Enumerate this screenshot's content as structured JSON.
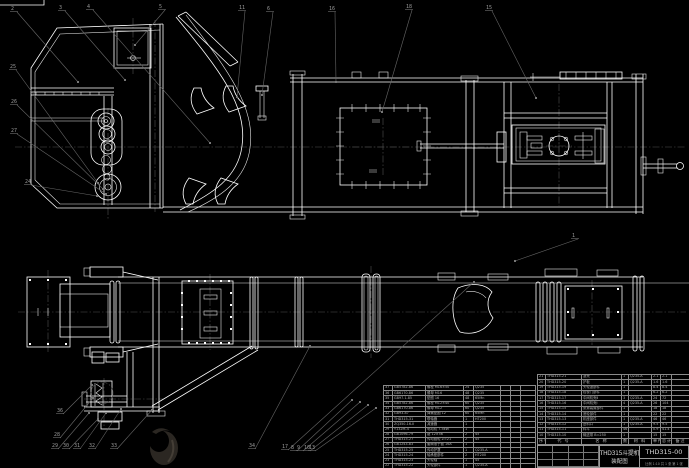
{
  "colors": {
    "background": "#000000",
    "line": "#ffffff",
    "leader": "#707070",
    "table_text": "#b0b0b0"
  },
  "title_block": {
    "product": "THD315斗提机",
    "doc_type": "装配图",
    "drawing_no": "THD315-00",
    "footer": "比例 1:10  共 1 张  第 1 张"
  },
  "bom_right": {
    "header": [
      "序号",
      "代  号",
      "名  称",
      "数量",
      "材  料",
      "单件",
      "总计",
      "备注"
    ],
    "rows": [
      [
        "21",
        "THD315-21",
        "罩壳",
        "1",
        "Q235-A",
        "2.1",
        "2.1",
        ""
      ],
      [
        "20",
        "THD315-20",
        "护板",
        "1",
        "Q235-A",
        "1.6",
        "1.6",
        ""
      ],
      [
        "19",
        "THD315-19",
        "头轮罩部件",
        "1",
        "",
        "8.4",
        "8.4",
        ""
      ],
      [
        "18",
        "THD315-18",
        "检视门部件",
        "1",
        "",
        "6.2",
        "6.2",
        ""
      ],
      [
        "17",
        "THD315-17",
        "中间机壳Ⅱ",
        "3",
        "Q235-A",
        "24",
        "72",
        ""
      ],
      [
        "16",
        "THD315-16",
        "中间机壳Ⅰ",
        "4",
        "Q235-A",
        "26",
        "104",
        ""
      ],
      [
        "15",
        "THD315-15",
        "张紧装置部件",
        "1",
        "",
        "18",
        "18",
        ""
      ],
      [
        "14",
        "THD315-14",
        "底轮部件",
        "1",
        "",
        "22",
        "22",
        ""
      ],
      [
        "13",
        "THD315-13",
        "机座部件",
        "1",
        "Q235-A",
        "46",
        "46",
        ""
      ],
      [
        "12",
        "THD315-12",
        "进料口",
        "1",
        "Q235-A",
        "9.5",
        "9.5",
        ""
      ],
      [
        "11",
        "THD315-11",
        "料斗",
        "46",
        "",
        "0.9",
        "41.4",
        ""
      ],
      [
        "10",
        "THD315-10",
        "输送带 B=250",
        "1",
        "",
        "15",
        "15",
        ""
      ]
    ]
  },
  "bom_left": {
    "rows": [
      [
        "37",
        "GB5782-86",
        "螺栓 M16×50",
        "24",
        "Q235",
        "",
        "",
        ""
      ],
      [
        "36",
        "GB6170-86",
        "螺母 M16",
        "48",
        "Q235",
        "",
        "",
        ""
      ],
      [
        "35",
        "GB97.1-85",
        "垫圈 16",
        "48",
        "65Mn",
        "",
        "",
        ""
      ],
      [
        "34",
        "GB5782-86",
        "螺栓 M12×40",
        "60",
        "Q235",
        "",
        "",
        ""
      ],
      [
        "33",
        "GB6170-86",
        "螺母 M12",
        "60",
        "Q235",
        "",
        "",
        ""
      ],
      [
        "32",
        "GB93-87",
        "弹簧垫圈 12",
        "60",
        "65Mn",
        "",
        "",
        ""
      ],
      [
        "31",
        "THD315-31",
        "联轴器",
        "1",
        "HT200",
        "",
        "",
        ""
      ],
      [
        "30",
        "ZQ350-16-Ⅱ",
        "减速器",
        "1",
        "",
        "",
        "",
        ""
      ],
      [
        "29",
        "Y132M-4",
        "电动机 7.5kW",
        "1",
        "",
        "",
        "",
        ""
      ],
      [
        "28",
        "GB1096-79",
        "键 12×56",
        "2",
        "45",
        "",
        "",
        ""
      ],
      [
        "27",
        "THD315-27",
        "传动链轮 Z=21",
        "2",
        "45",
        "",
        "",
        ""
      ],
      [
        "26",
        "GB1243-83",
        "套筒滚子链 16A",
        "1",
        "",
        "",
        "",
        ""
      ],
      [
        "25",
        "THD315-25",
        "传动护罩",
        "1",
        "Q235-A",
        "",
        "",
        ""
      ],
      [
        "24",
        "THD315-24",
        "轴承座部件",
        "2",
        "HT200",
        "",
        "",
        ""
      ],
      [
        "23",
        "THD315-23",
        "头轮轴",
        "1",
        "45",
        "",
        "",
        ""
      ],
      [
        "22",
        "THD315-22",
        "头轮部件",
        "1",
        "Q235-A",
        "",
        "",
        ""
      ]
    ]
  },
  "balloons": [
    {
      "label": "2",
      "x": 12,
      "y": 10,
      "lx": 78,
      "ly": 82
    },
    {
      "label": "3",
      "x": 60,
      "y": 9,
      "lx": 125,
      "ly": 80
    },
    {
      "label": "4",
      "x": 88,
      "y": 8,
      "lx": 210,
      "ly": 143
    },
    {
      "label": "5",
      "x": 160,
      "y": 8,
      "lx": 135,
      "ly": 45
    },
    {
      "label": "11",
      "x": 240,
      "y": 9,
      "lx": 237,
      "ly": 97
    },
    {
      "label": "6",
      "x": 268,
      "y": 10,
      "lx": 262,
      "ly": 95
    },
    {
      "label": "16",
      "x": 330,
      "y": 10,
      "lx": 336,
      "ly": 82
    },
    {
      "label": "18",
      "x": 407,
      "y": 8,
      "lx": 382,
      "ly": 112
    },
    {
      "label": "15",
      "x": 487,
      "y": 9,
      "lx": 536,
      "ly": 98
    },
    {
      "label": "25",
      "x": 11,
      "y": 68,
      "lx": 98,
      "ly": 183
    },
    {
      "label": "26",
      "x": 12,
      "y": 103,
      "lx": 103,
      "ly": 189
    },
    {
      "label": "27",
      "x": 12,
      "y": 132,
      "lx": 106,
      "ly": 194
    },
    {
      "label": "24",
      "x": 26,
      "y": 183,
      "lx": 97,
      "ly": 196
    },
    {
      "label": "1",
      "x": 573,
      "y": 237,
      "lx": 515,
      "ly": 261
    },
    {
      "label": "36",
      "x": 58,
      "y": 412,
      "lx": 92,
      "ly": 385
    },
    {
      "label": "28",
      "x": 55,
      "y": 436,
      "lx": 93,
      "ly": 398
    },
    {
      "label": "29",
      "x": 53,
      "y": 447,
      "lx": 89,
      "ly": 413
    },
    {
      "label": "30",
      "x": 64,
      "y": 447,
      "lx": 98,
      "ly": 419
    },
    {
      "label": "31",
      "x": 75,
      "y": 447,
      "lx": 106,
      "ly": 413
    },
    {
      "label": "32",
      "x": 90,
      "y": 447,
      "lx": 121,
      "ly": 409
    },
    {
      "label": "33",
      "x": 112,
      "y": 447,
      "lx": 152,
      "ly": 410
    },
    {
      "label": "34",
      "x": 250,
      "y": 447,
      "lx": 310,
      "ly": 346
    },
    {
      "label": "17",
      "x": 283,
      "y": 448,
      "lx": 474,
      "ly": 282
    },
    {
      "label": "8",
      "x": 292,
      "y": 449,
      "lx": 352,
      "ly": 400
    },
    {
      "label": "9",
      "x": 298,
      "y": 449,
      "lx": 360,
      "ly": 402
    },
    {
      "label": "10",
      "x": 305,
      "y": 449,
      "lx": 368,
      "ly": 405
    },
    {
      "label": "13",
      "x": 310,
      "y": 449,
      "lx": 376,
      "ly": 408
    }
  ]
}
